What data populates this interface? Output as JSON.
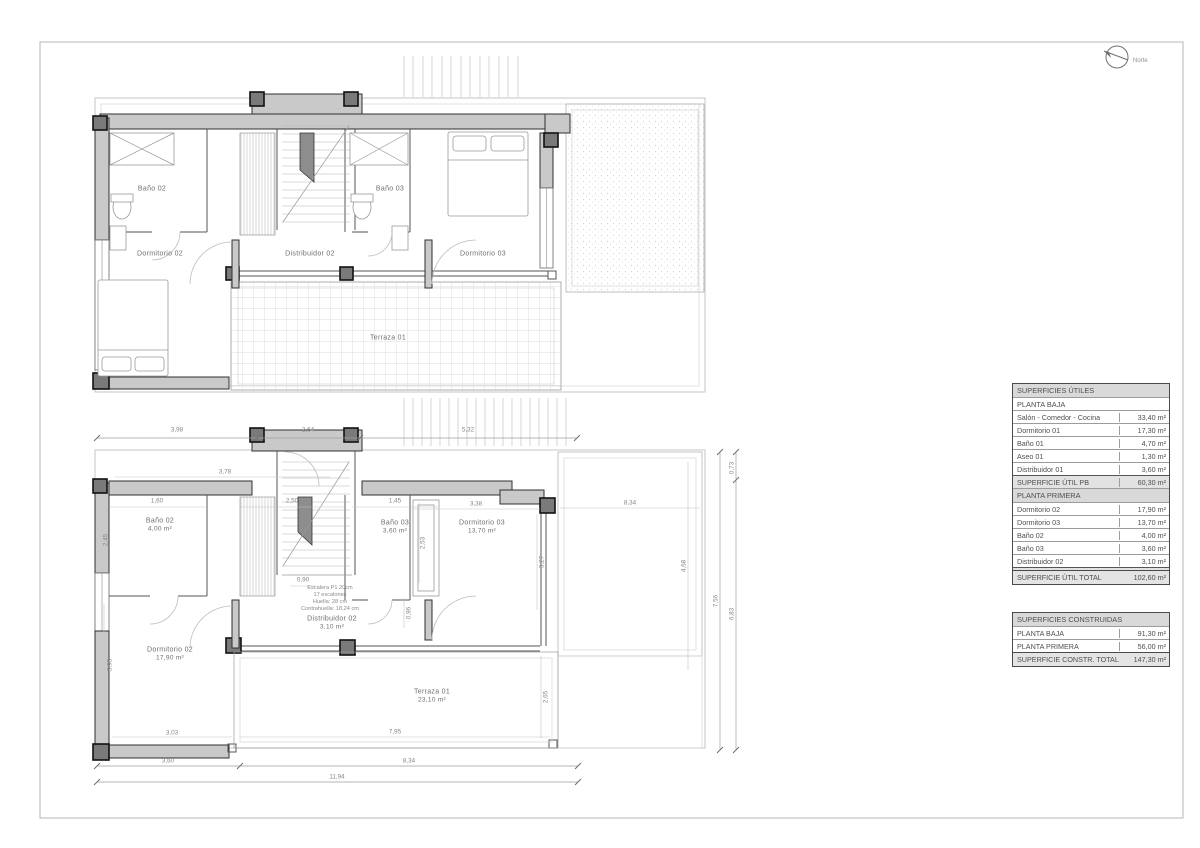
{
  "page": {
    "north_label": "Norte"
  },
  "upper_plan": {
    "rooms": [
      {
        "label": "Baño 02"
      },
      {
        "label": "Baño 03"
      },
      {
        "label": "Dormitorio 02"
      },
      {
        "label": "Distribuidor 02"
      },
      {
        "label": "Dormitorio 03"
      },
      {
        "label": "Terraza 01"
      }
    ]
  },
  "lower_plan": {
    "rooms": [
      {
        "label": "Baño 02",
        "area": "4,00 m²"
      },
      {
        "label": "Baño 03",
        "area": "3,60 m²"
      },
      {
        "label": "Dormitorio 03",
        "area": "13,70 m²"
      },
      {
        "label": "Dormitorio 02",
        "area": "17,90 m²"
      },
      {
        "label": "Distribuidor 02",
        "area": "3,10 m²"
      },
      {
        "label": "Terraza 01",
        "area": "23,10 m²"
      }
    ],
    "stair_note": [
      "Escalera P1 20cm",
      "17 escalones",
      "Huella: 28 cm",
      "Contrahuella: 18,24 cm"
    ],
    "dims_top": [
      "3,98",
      "2,64",
      "5,32"
    ],
    "dims_bottom": [
      "3,60",
      "8,34",
      "11,94"
    ],
    "dims_right": [
      "0,73",
      "7,56",
      "6,83"
    ],
    "dims_inner": [
      "3,78",
      "1,60",
      "2,50",
      "1,45",
      "3,38",
      "8,34",
      "0,90",
      "2,45",
      "3,93",
      "2,53",
      "3,27",
      "0,96",
      "4,68",
      "2,65",
      "3,03",
      "7,95"
    ]
  },
  "tables": {
    "utiles": {
      "title": "SUPERFICIES ÚTILES",
      "sections": [
        {
          "header": "PLANTA BAJA",
          "rows": [
            [
              "Salón - Comedor - Cocina",
              "33,40 m²"
            ],
            [
              "Dormitorio 01",
              "17,30 m²"
            ],
            [
              "Baño 01",
              "4,70 m²"
            ],
            [
              "Aseo 01",
              "1,30 m²"
            ],
            [
              "Distribuidor 01",
              "3,60 m²"
            ]
          ],
          "total": [
            "SUPERFICIE ÚTIL PB",
            "60,30 m²"
          ]
        },
        {
          "header": "PLANTA PRIMERA",
          "rows": [
            [
              "Dormitorio 02",
              "17,90 m²"
            ],
            [
              "Dormitorio 03",
              "13,70 m²"
            ],
            [
              "Baño 02",
              "4,00 m²"
            ],
            [
              "Baño 03",
              "3,60 m²"
            ],
            [
              "Distribuidor 02",
              "3,10 m²"
            ]
          ],
          "total": [
            "SUPERFICIE ÚTIL P1",
            "42,30 m²"
          ]
        }
      ],
      "grand_total": [
        "SUPERFICIE ÚTIL TOTAL",
        "102,60 m²"
      ]
    },
    "construidas": {
      "title": "SUPERFICIES CONSTRUIDAS",
      "rows": [
        [
          "PLANTA BAJA",
          "91,30 m²"
        ],
        [
          "PLANTA PRIMERA",
          "56,00 m²"
        ]
      ],
      "total": [
        "SUPERFICIE CONSTR. TOTAL",
        "147,30 m²"
      ]
    }
  }
}
